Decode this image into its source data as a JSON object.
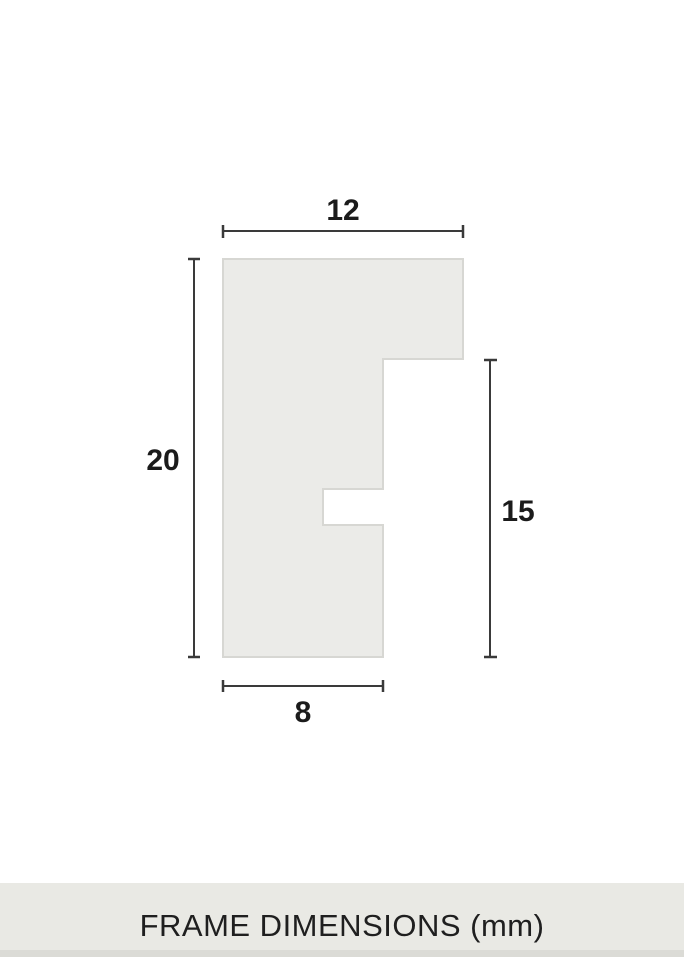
{
  "diagram": {
    "type": "frame-moulding-profile-cross-section",
    "footer_title": "FRAME DIMENSIONS (mm)",
    "unit": "mm",
    "dimensions": {
      "top_width": "12",
      "overall_height": "20",
      "rabbet_side_height": "15",
      "bottom_width": "8"
    },
    "profile_points": "223,259 463,259 463,359 383,359 383,489 323,489 323,525 383,525 383,657 223,657",
    "colors": {
      "canvas_bg": "#ffffff",
      "profile_fill": "#ebebe8",
      "profile_stroke": "#d7d7d3",
      "dimension_line": "#3a3a3a",
      "label_text": "#1b1b1b",
      "footer_bg": "#e9e9e4",
      "footer_edge": "#dbdbd6",
      "footer_text": "#1f1f1f"
    }
  }
}
